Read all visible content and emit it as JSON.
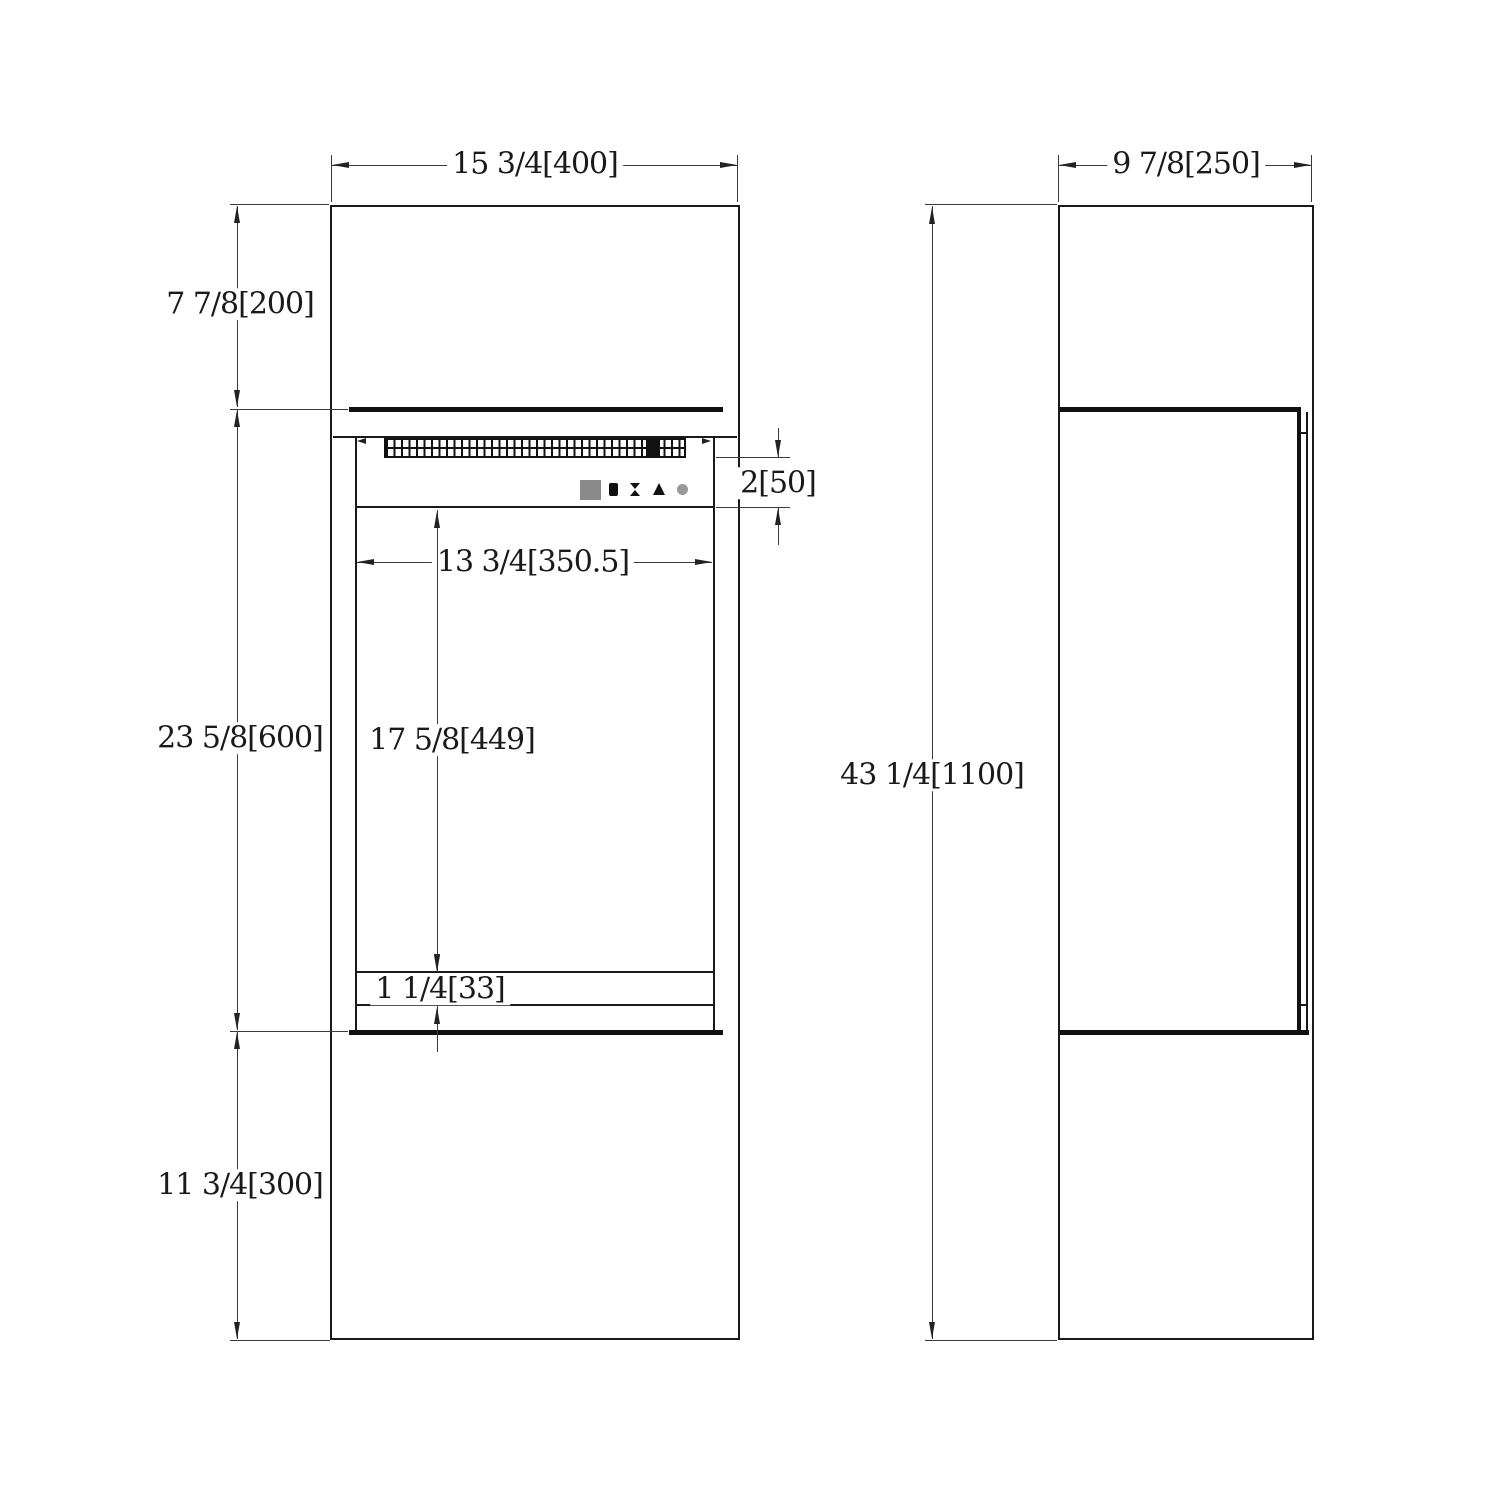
{
  "drawing": {
    "type": "technical-dimension-drawing",
    "views": {
      "front": {
        "name": "front view"
      },
      "side": {
        "name": "side view"
      }
    },
    "dims": {
      "front_width": "15 3/4[400]",
      "top_section_height": "7 7/8[200]",
      "insert_section_height": "23 5/8[600]",
      "base_section_height": "11 3/4[300]",
      "control_band_height": "2[50]",
      "glass_width": "13 3/4[350.5]",
      "glass_height": "17 5/8[449]",
      "bottom_gap": "1 1/4[33]",
      "side_depth": "9 7/8[250]",
      "overall_height": "43 1/4[1100]"
    },
    "control_panel": {
      "icons": [
        "display-screen",
        "flame-icon",
        "timer-icon",
        "tree-flame-icon",
        "power-icon"
      ]
    },
    "colors": {
      "object_line": "#1a1a1a",
      "dimension_line": "#3a3a3a",
      "display_gray": "#8a8a8a",
      "power_gray": "#999999",
      "background": "#ffffff"
    }
  }
}
